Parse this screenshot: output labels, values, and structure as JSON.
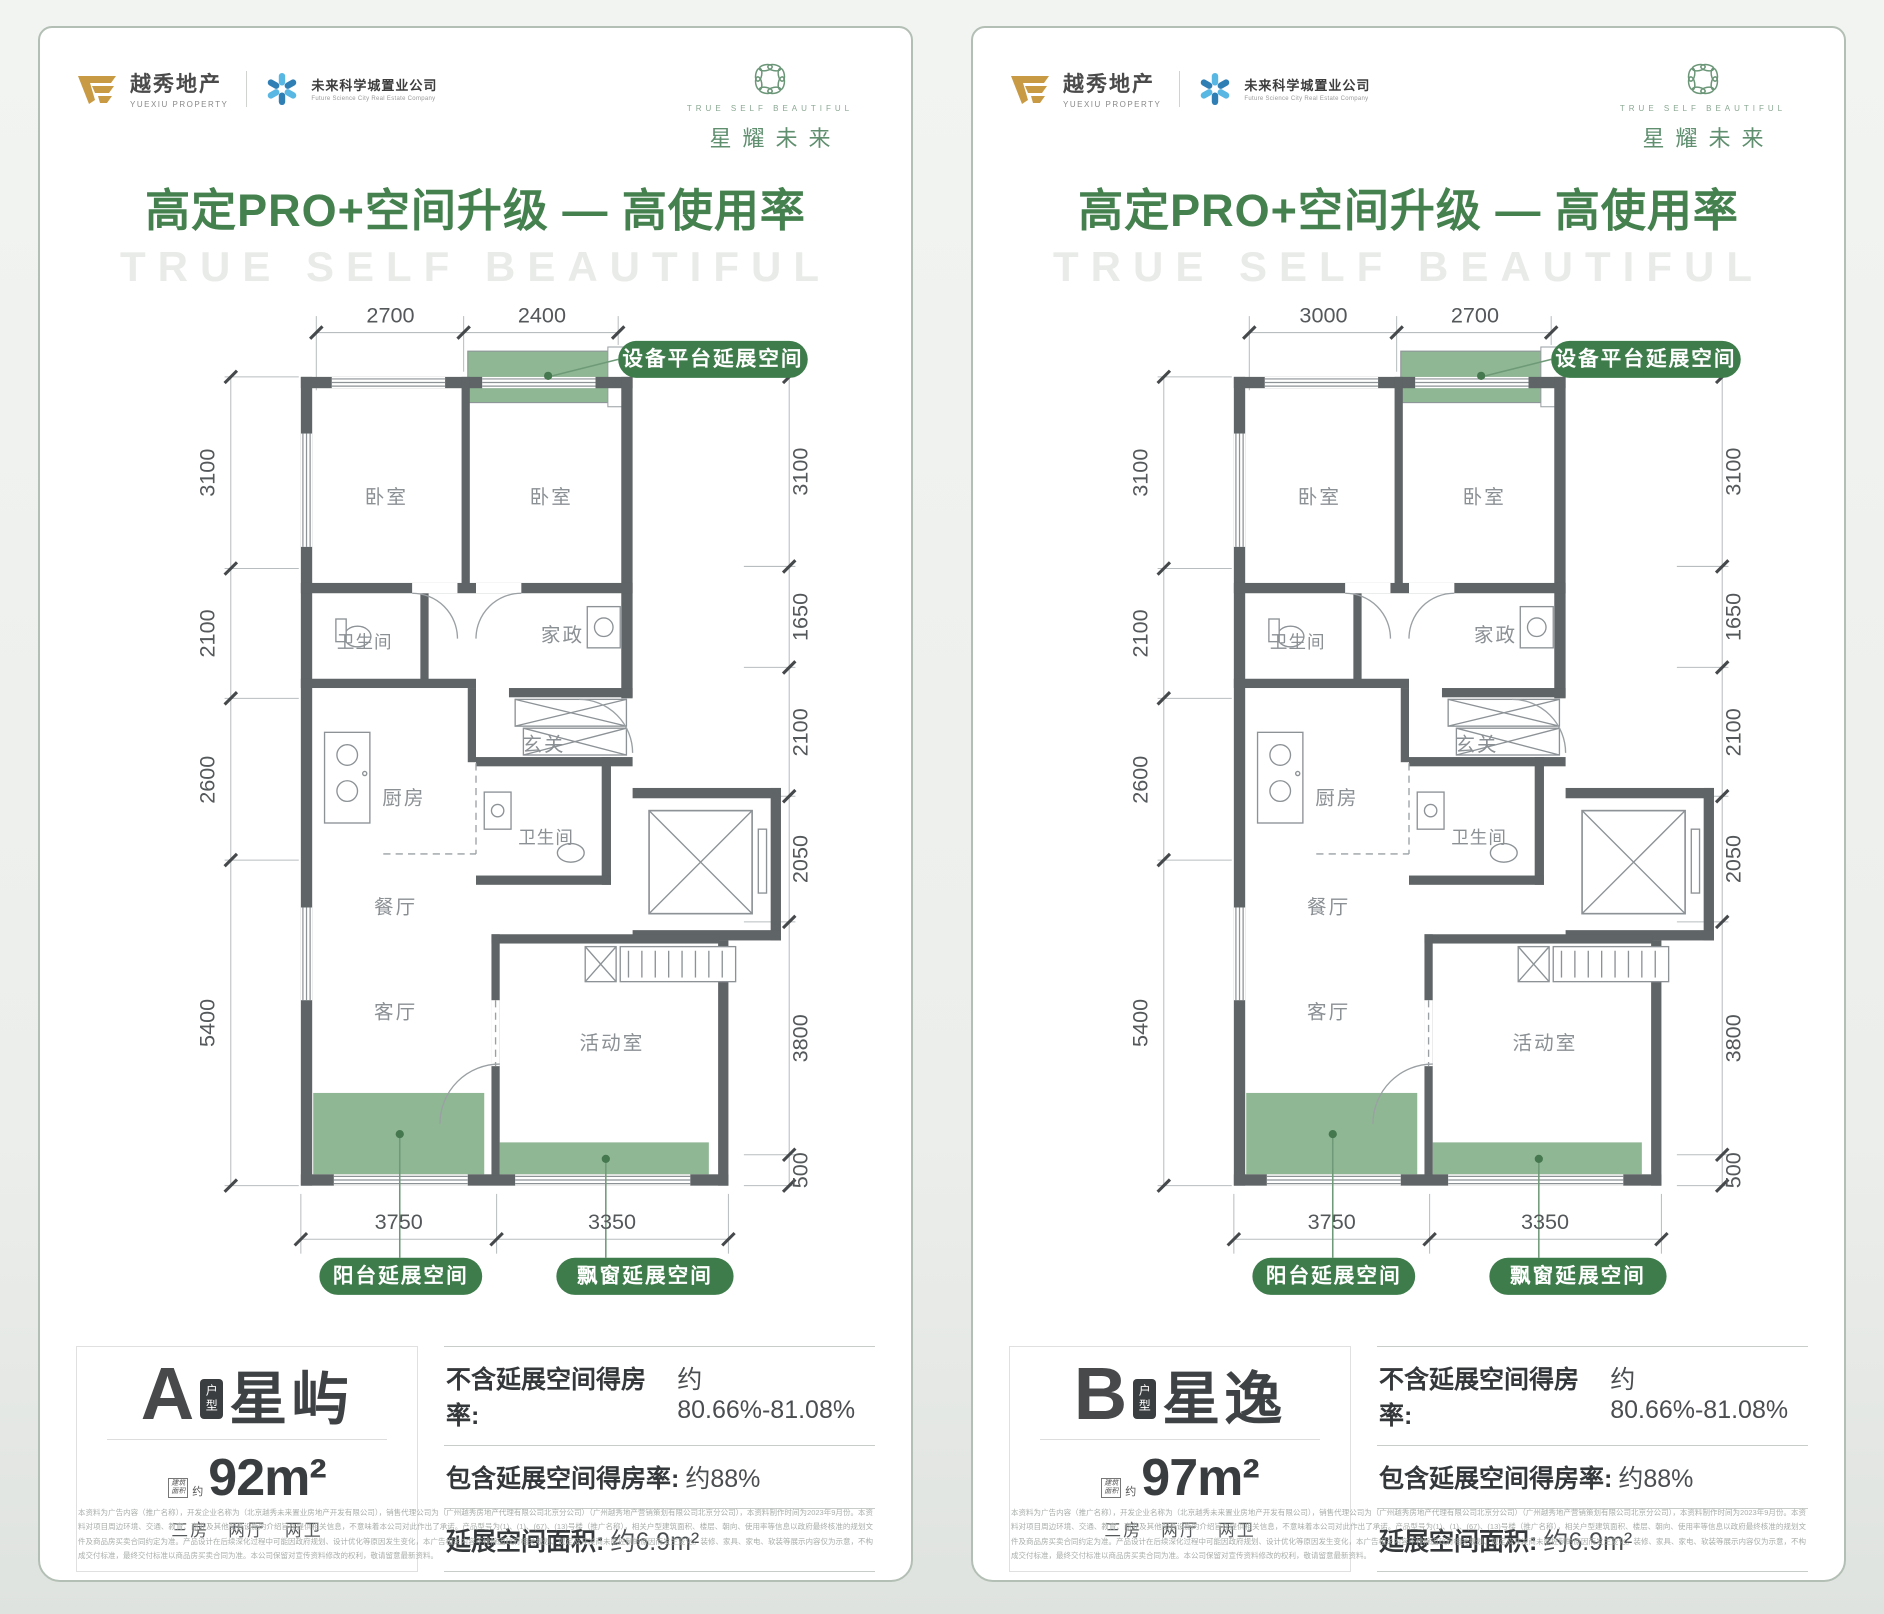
{
  "brand": {
    "yuexiu": {
      "name": "越秀地产",
      "sub": "YUEXIU PROPERTY"
    },
    "partner": {
      "name": "未来科学城置业公司",
      "sub": "Future Science City Real Estate Company"
    },
    "emblem": {
      "caption": "TRUE SELF BEAUTIFUL",
      "title": "星耀未来"
    }
  },
  "heading": {
    "title": "高定PRO+空间升级 — 高使用率",
    "watermark": "TRUE SELF BEAUTIFUL"
  },
  "rooms": {
    "bedroom1": "卧室",
    "bedroom2": "卧室",
    "bath1": "卫生间",
    "laundry": "家政",
    "foyer": "玄关",
    "kitchen": "厨房",
    "bath2": "卫生间",
    "dining": "餐厅",
    "living": "客厅",
    "activity": "活动室"
  },
  "callouts": {
    "platform": "设备平台延展空间",
    "balcony": "阳台延展空间",
    "bay_window": "飘窗延展空间"
  },
  "cards": [
    {
      "unit_letter": "A",
      "unit_badge": "户型",
      "unit_name": "星屿",
      "area_badge_line1": "建筑",
      "area_badge_line2": "面积",
      "area_prefix": "约",
      "area_value": "92m²",
      "layout": "三房 两厅 两卫",
      "stats": [
        {
          "label": "不含延展空间得房率:",
          "value": "约80.66%-81.08%"
        },
        {
          "label": "包含延展空间得房率:",
          "value": "约88%"
        },
        {
          "label": "延展空间面积:",
          "value": "约6.9m²"
        }
      ],
      "dims": {
        "top": [
          "2700",
          "2400"
        ],
        "left": [
          "3100",
          "2100",
          "2600",
          "5400"
        ],
        "right": [
          "3100",
          "1650",
          "2100",
          "2050",
          "3800",
          "500"
        ],
        "bottom": [
          "3750",
          "3350"
        ]
      }
    },
    {
      "unit_letter": "B",
      "unit_badge": "户型",
      "unit_name": "星逸",
      "area_badge_line1": "建筑",
      "area_badge_line2": "面积",
      "area_prefix": "约",
      "area_value": "97m²",
      "layout": "三房 两厅 两卫",
      "stats": [
        {
          "label": "不含延展空间得房率:",
          "value": "约80.66%-81.08%"
        },
        {
          "label": "包含延展空间得房率:",
          "value": "约88%"
        },
        {
          "label": "延展空间面积:",
          "value": "约6.9m²"
        }
      ],
      "dims": {
        "top": [
          "3000",
          "2700"
        ],
        "left": [
          "3100",
          "2100",
          "2600",
          "5400"
        ],
        "right": [
          "3100",
          "1650",
          "2100",
          "2050",
          "3800",
          "500"
        ],
        "bottom": [
          "3750",
          "3350"
        ]
      }
    }
  ],
  "disclaimer": "本资料为广告内容（推广名称），开发企业名称为（北京越秀未来置业房地产开发有限公司），销售代理公司为（广州越秀房地产代理有限公司北京分公司）（广州越秀地产营销策划有限公司北京分公司），本资料制作时间为2023年9月份。本资料对项目周边环境、交通、教育、商业及其他配套设施的介绍旨在提供相关信息，不意味着本公司对此作出了承诺。产品型号为(1)、(1)、(67)、(13)号楼（推广名称），相关户型建筑面积、楼层、朝向、使用率等信息以政府最终核准的规划文件及商品房买卖合同约定为准。产品设计在后续深化过程中可能因政府规划、设计优化等原因发生变化，本广告相关内容不排除因政府相关规划、规定及开发商未能控制的原因而发生变化。装修、家具、家电、软装等展示内容仅为示意，不构成交付标准，最终交付标准以商品房买卖合同为准。本公司保留对宣传资料修改的权利，敬请留意最新资料。",
  "colors": {
    "heading_green": "#44814f",
    "pill_green": "#3e7c4b",
    "plan_green": "#8fb794",
    "wall_gray": "#5f6466",
    "accent_gold": "#c99a44",
    "accent_blue": "#3f9fd0"
  }
}
